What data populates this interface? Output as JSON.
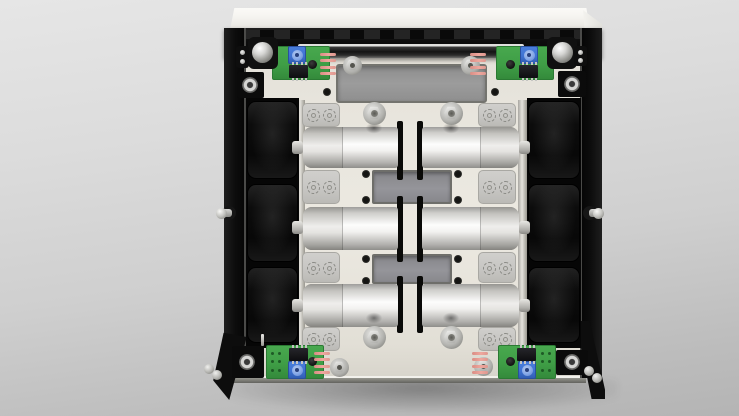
{
  "scene": {
    "subject": "top-down 3D CAD render of an open electronics enclosure: capacitor bank module with six black electrolytic capacitors, six white film capacitors, four green driver PCBs with blue trim potentiometers, clamp plates and chassis screws",
    "text_visible": "none"
  },
  "palette": {
    "bg_top": "#e6e6e6",
    "bg_bottom": "#b4b4b4",
    "lid": "#f6f5f1",
    "chassis_black": "#0d0d0d",
    "plate_cream": "#e9e6de",
    "recess_gray": "#949494",
    "clamp_gray": "#c8c7c4",
    "cylinder_white": "#fdfdfc",
    "cap_black": "#111111",
    "pcb_green": "#3f9e46",
    "trimmer_blue": "#3f73d3",
    "trimmer_dial": "#84a7e7",
    "pin_pink": "#efa79e",
    "screw_silver": "#cfcfcd",
    "ic_black": "#17171a"
  },
  "inventory": {
    "black_electrolytic_capacitors": 6,
    "white_film_capacitors": 6,
    "green_pcbs": 4,
    "blue_trim_pots": 4,
    "dip_ics": 4,
    "pink_pin_headers": 4,
    "clamp_plates": 8,
    "hex_screws": 4,
    "hex_standoffs": 4,
    "dome_screws": 2,
    "ring_screws": 4
  },
  "geometry": {
    "shadow": {
      "x": 226,
      "y": 378,
      "w": 392,
      "h": 34
    },
    "lid": {
      "x": 230,
      "y": 8,
      "w": 360,
      "h": 22
    },
    "lidFlap": {
      "x": 583,
      "y": 10,
      "w": 19,
      "h": 88
    },
    "plate": {
      "x": 244,
      "y": 54,
      "w": 338,
      "h": 322
    },
    "bottomRim": {
      "x": 226,
      "y": 376,
      "w": 360,
      "h": 7
    },
    "topBar": {
      "x": 224,
      "y": 28,
      "w": 378,
      "h": 30
    },
    "rail": {
      "x": 298,
      "y": 44,
      "w": 226,
      "h": 14
    },
    "leftWall": {
      "x": 224,
      "y": 28,
      "w": 22,
      "h": 350
    },
    "rightWall": {
      "x": 580,
      "y": 28,
      "w": 22,
      "h": 350
    },
    "flapBL": {
      "x": 210,
      "y": 330,
      "w": 40,
      "h": 70
    },
    "flapBR": {
      "x": 573,
      "y": 321,
      "w": 32,
      "h": 78
    },
    "sideRails": [
      {
        "x": 296,
        "y": 100,
        "w": 9,
        "h": 246
      },
      {
        "x": 518,
        "y": 100,
        "w": 9,
        "h": 246
      }
    ],
    "capBanks": [
      {
        "x": 246,
        "y": 98,
        "w": 53,
        "h": 250
      },
      {
        "x": 527,
        "y": 98,
        "w": 54,
        "h": 250
      }
    ],
    "caps": {
      "ys": [
        {
          "y": 101,
          "h": 78
        },
        {
          "y": 184,
          "h": 78
        },
        {
          "y": 267,
          "h": 76
        }
      ],
      "xs": [
        {
          "x": 247,
          "w": 51
        },
        {
          "x": 528,
          "w": 52
        }
      ]
    },
    "capNubs": {
      "xs": [
        292,
        519
      ],
      "ys": [
        141,
        221,
        299
      ],
      "w": 11,
      "h": 13
    },
    "topRecess": {
      "x": 336,
      "y": 64,
      "w": 151,
      "h": 39
    },
    "midRecesses": [
      {
        "x": 372,
        "y": 170,
        "w": 80,
        "h": 34
      },
      {
        "x": 372,
        "y": 254,
        "w": 80,
        "h": 30
      }
    ],
    "holes": [
      [
        327,
        92
      ],
      [
        495,
        92
      ],
      [
        366,
        174
      ],
      [
        366,
        200
      ],
      [
        458,
        174
      ],
      [
        458,
        200
      ],
      [
        366,
        259
      ],
      [
        366,
        281
      ],
      [
        458,
        259
      ],
      [
        458,
        281
      ]
    ],
    "slots": {
      "xs": [
        397,
        417
      ],
      "w": 6,
      "segs": [
        {
          "y": 121,
          "h": 59
        },
        {
          "y": 196,
          "h": 66
        },
        {
          "y": 276,
          "h": 57
        }
      ]
    },
    "clamps": {
      "xs": [
        302,
        478
      ],
      "w": 38,
      "segs": [
        {
          "y": 103,
          "h": 24
        },
        {
          "y": 170,
          "h": 34
        },
        {
          "y": 252,
          "h": 31
        },
        {
          "y": 327,
          "h": 24
        }
      ]
    },
    "cylinders": {
      "rows": [
        {
          "y": 127,
          "h": 41
        },
        {
          "y": 207,
          "h": 43
        },
        {
          "y": 284,
          "h": 43
        }
      ],
      "left": {
        "x": 303,
        "w": 95,
        "seam": 40
      },
      "right": {
        "x": 422,
        "w": 97,
        "seam": 58
      }
    },
    "smudges": [
      [
        374,
        128
      ],
      [
        451,
        128
      ],
      [
        374,
        318
      ],
      [
        451,
        318
      ]
    ],
    "hexScrews": [
      [
        374,
        113
      ],
      [
        451,
        113
      ],
      [
        374,
        337
      ],
      [
        451,
        337
      ]
    ],
    "standoffs": [
      [
        352,
        65
      ],
      [
        470,
        65
      ],
      [
        339,
        367
      ],
      [
        483,
        366
      ]
    ],
    "pcbs": [
      {
        "x": 272,
        "y": 46,
        "w": 58,
        "h": 34,
        "trimmer": [
          288,
          46
        ],
        "ic": [
          289,
          65
        ],
        "dot": [
          312,
          64
        ],
        "pins": {
          "x": 320,
          "y": 53,
          "dir": 1
        },
        "vias": null
      },
      {
        "x": 496,
        "y": 46,
        "w": 58,
        "h": 34,
        "trimmer": [
          520,
          46
        ],
        "ic": [
          519,
          65
        ],
        "dot": [
          510,
          64
        ],
        "pins": {
          "x": 486,
          "y": 53,
          "dir": -1
        },
        "vias": null
      },
      {
        "x": 266,
        "y": 345,
        "w": 58,
        "h": 34,
        "trimmer": [
          288,
          361
        ],
        "ic": [
          289,
          348
        ],
        "dot": [
          312,
          361
        ],
        "pins": {
          "x": 314,
          "y": 352,
          "dir": 1
        },
        "vias": [
          272,
          353
        ]
      },
      {
        "x": 498,
        "y": 345,
        "w": 58,
        "h": 34,
        "trimmer": [
          518,
          361
        ],
        "ic": [
          517,
          348
        ],
        "dot": [
          510,
          361
        ],
        "pins": {
          "x": 488,
          "y": 352,
          "dir": -1
        },
        "vias": [
          542,
          353
        ]
      }
    ],
    "domeScrews": [
      {
        "bracket": [
          248,
          37,
          30,
          32
        ],
        "c": [
          262,
          52
        ]
      },
      {
        "bracket": [
          547,
          37,
          30,
          32
        ],
        "c": [
          562,
          52
        ]
      }
    ],
    "ringScrews": [
      {
        "sq": [
          237,
          72,
          27,
          26
        ],
        "c": [
          250,
          85
        ]
      },
      {
        "sq": [
          558,
          71,
          28,
          26
        ],
        "c": [
          572,
          84
        ]
      },
      {
        "sq": [
          232,
          346,
          32,
          32
        ],
        "c": [
          247,
          362
        ]
      },
      {
        "sq": [
          556,
          350,
          32,
          25
        ],
        "c": [
          572,
          362
        ]
      }
    ],
    "knobs": [
      {
        "x": 236,
        "y": 46,
        "w": 13,
        "h": 22,
        "dots": [
          [
            242,
            52
          ],
          [
            242,
            61
          ]
        ]
      },
      {
        "x": 574,
        "y": 46,
        "w": 13,
        "h": 20,
        "dots": [
          [
            580,
            52
          ],
          [
            580,
            60
          ]
        ]
      }
    ],
    "sideScrews": [
      {
        "wall": [
          229,
          213
        ],
        "bead": [
          221,
          213
        ]
      },
      {
        "wall": [
          590,
          213
        ],
        "bead": [
          598,
          213
        ]
      }
    ],
    "cornerBeads": [
      [
        209,
        369
      ],
      [
        217,
        375
      ],
      [
        589,
        371
      ],
      [
        597,
        378
      ]
    ],
    "pinStick": {
      "x": 261,
      "y": 334,
      "w": 3,
      "h": 12
    }
  }
}
